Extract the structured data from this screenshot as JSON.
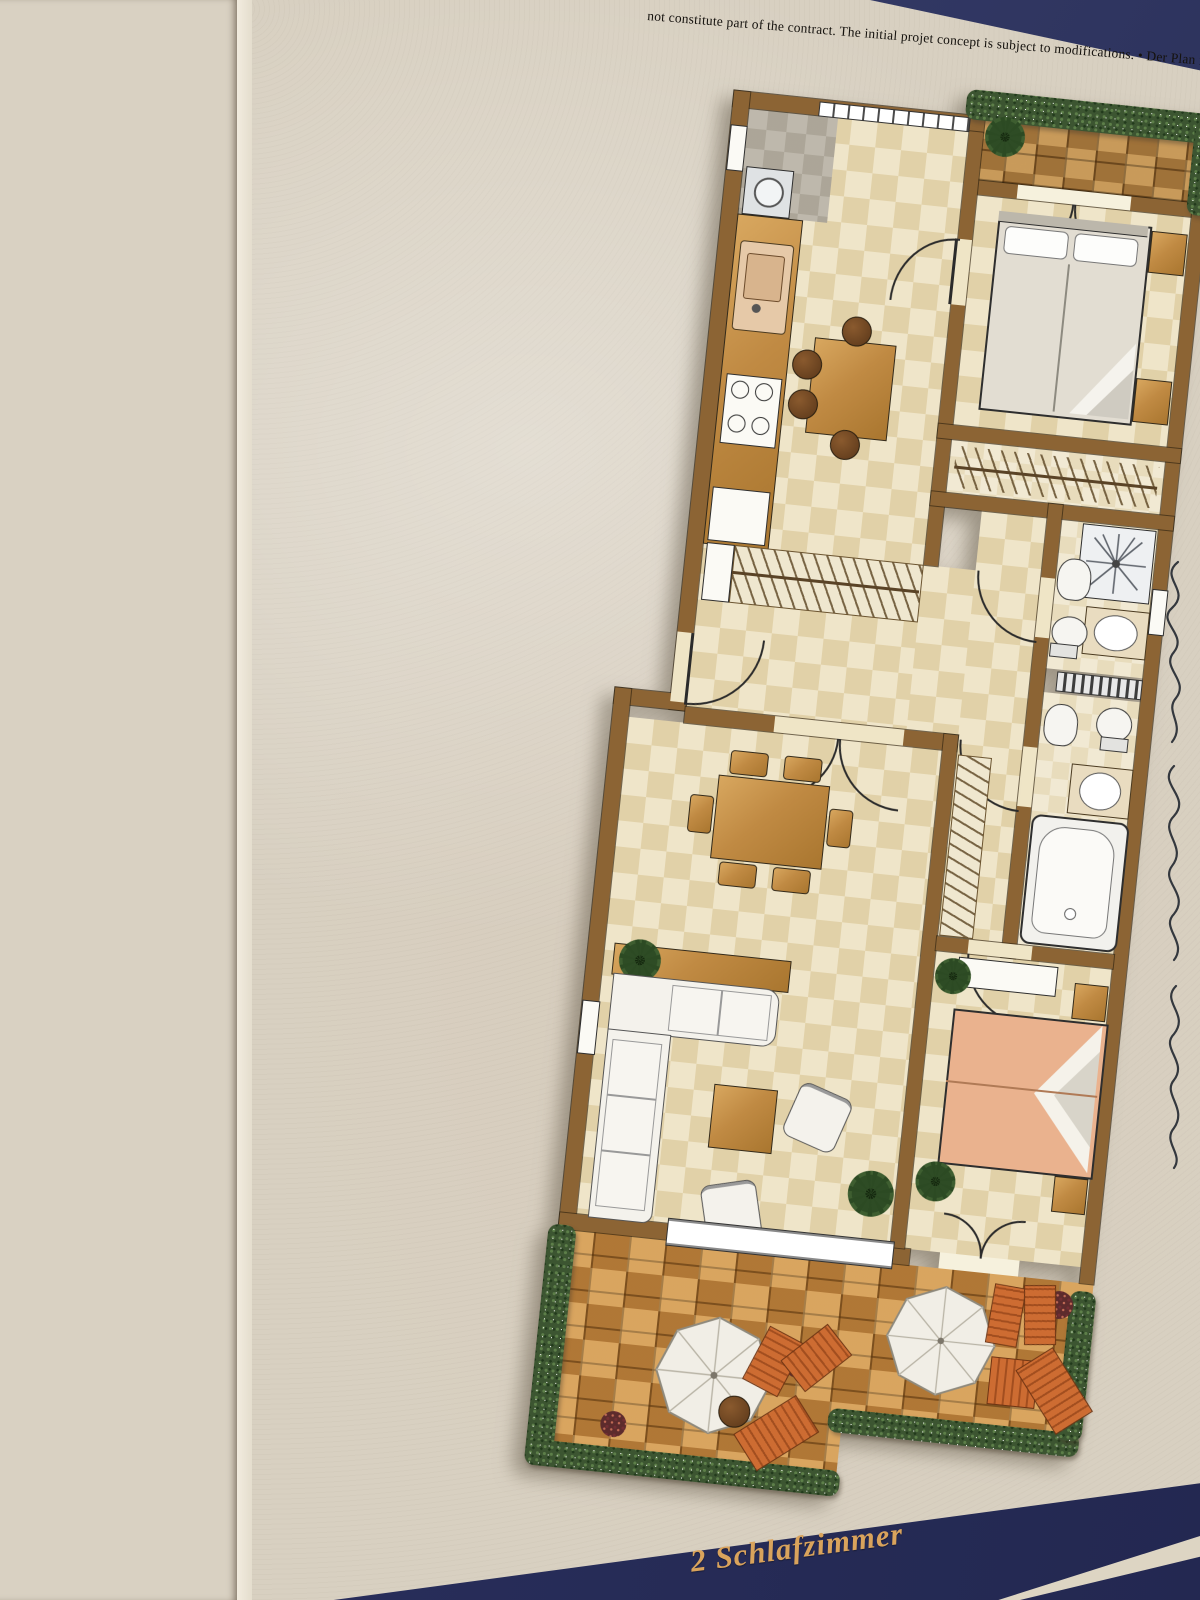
{
  "photo": {
    "description": "Photograph of a printed 2-bedroom apartment floor plan brochure lying beside a wooden table edge",
    "disclaimer": "not constitute part of the contract. The initial projet concept is subject to modifications. • Der Plan ist nicht verb",
    "footer": {
      "label": "2 Schlafzimmer"
    },
    "handwriting": {
      "description": "illegible vertical cursive pen note along right margin"
    },
    "colors": {
      "paper": "#d8d0c1",
      "wood_table": "#8d6f49",
      "navy_band": "#2b3160",
      "gold_text": "#d9a35c",
      "plan_wall": "#8c6434",
      "plan_floor": "#ece1c0",
      "terrace_tile": "#c88c44",
      "hedge_green": "#3c5531",
      "master_bed": "#eab28e"
    },
    "floor_plan": {
      "rooms": [
        "balcony",
        "bedroom-2",
        "kitchen-dining",
        "hallway",
        "wardrobe",
        "bathroom-1",
        "bathroom-2",
        "corridor",
        "living-room",
        "master-bedroom",
        "terrace"
      ],
      "fixtures": [
        "washing-machine",
        "kitchen-sink",
        "stove",
        "fridge",
        "kitchen-table",
        "double-bed",
        "wardrobe-rail",
        "shower",
        "washbasin",
        "toilet",
        "bidet",
        "towel-radiator",
        "bathtub",
        "dining-table",
        "corner-sofa",
        "coffee-table",
        "armchairs",
        "plants",
        "parasols",
        "sun-loungers",
        "hedges"
      ]
    }
  }
}
